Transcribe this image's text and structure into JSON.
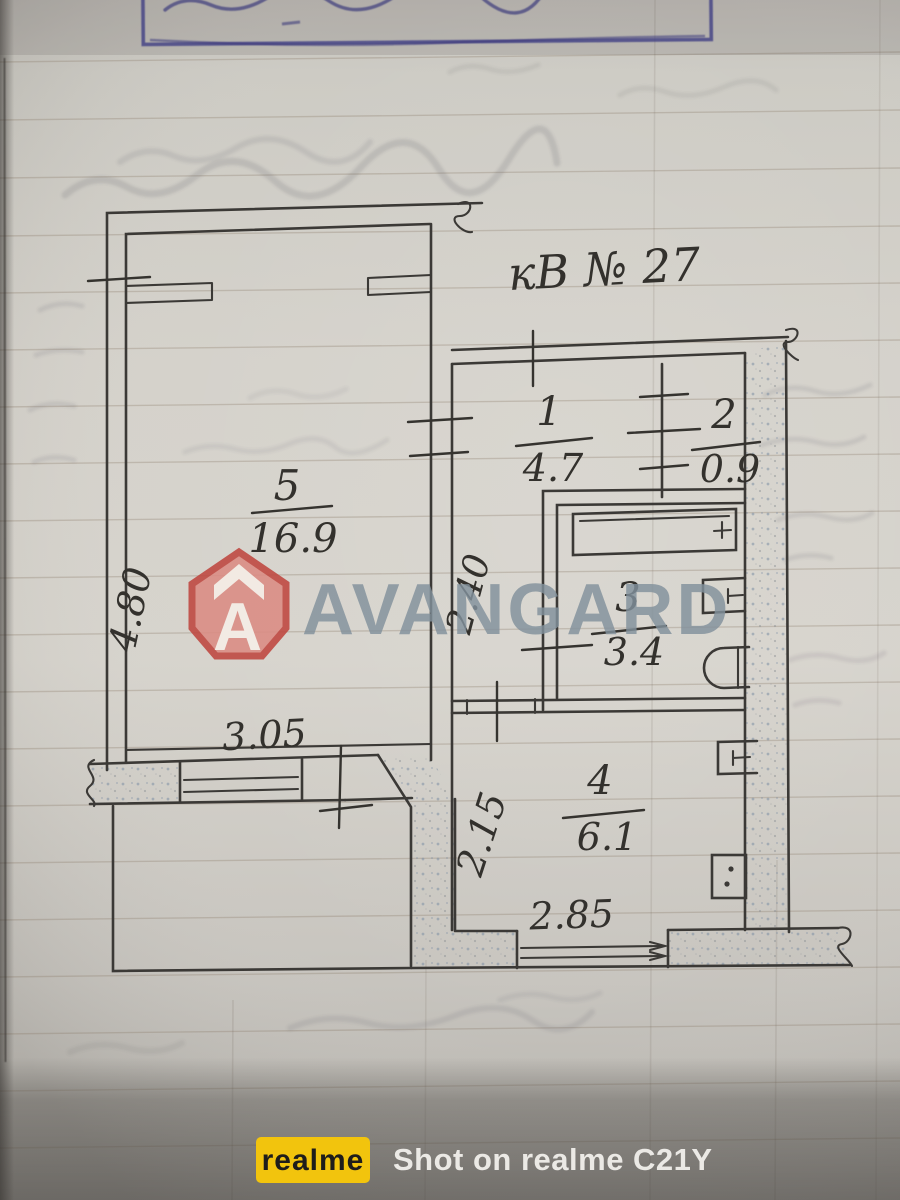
{
  "plan": {
    "apartment_label": "кВ № 27",
    "rooms": [
      {
        "id": "room-5",
        "number": "5",
        "area": "16.9"
      },
      {
        "id": "room-1",
        "number": "1",
        "area": "4.7"
      },
      {
        "id": "room-2",
        "number": "2",
        "area": "0.9"
      },
      {
        "id": "room-3",
        "number": "3",
        "area": "3.4"
      },
      {
        "id": "room-4",
        "number": "4",
        "area": "6.1"
      }
    ],
    "dimensions": {
      "left_side": "4.80",
      "room5_window": "3.05",
      "corridor_width": "2.40",
      "kitchen_side": "2.15",
      "kitchen_window": "2.85"
    }
  },
  "watermark_center": {
    "brand": "AVANGARD"
  },
  "watermark_bottom": {
    "badge": "realme",
    "caption": "Shot on realme C21Y"
  },
  "colors": {
    "logo_red": "#bf463f",
    "logo_red_fill": "#db8b83",
    "logo_gray": "#82919c",
    "stamp_blue": "#3d3d8f",
    "badge_yellow": "#f2c40d",
    "pencil": "#3b3936"
  }
}
